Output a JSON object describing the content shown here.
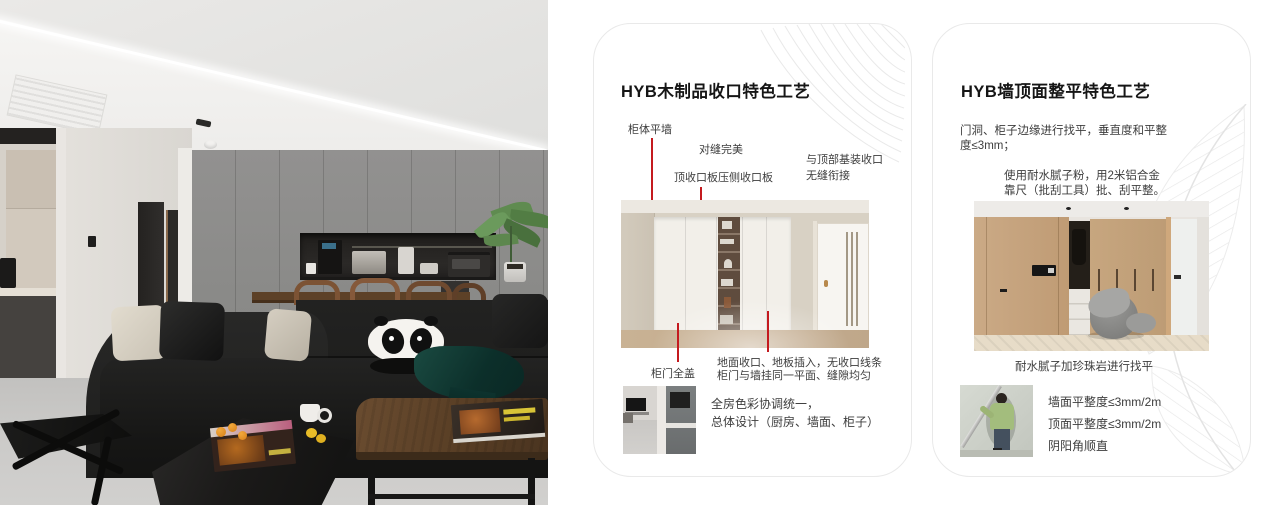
{
  "colors": {
    "accent_red": "#c41a1f",
    "card_border": "#e9e9e9",
    "title_text": "#151515",
    "body_text": "#3d3d3d"
  },
  "card1": {
    "title": "HYB木制品收口特色工艺",
    "callouts": {
      "cabinet_flush": "柜体平墙",
      "perfect_seam": "对缝完美",
      "top_board": "顶收口板压侧收口板",
      "ceiling_joint_1": "与顶部基装收口",
      "ceiling_joint_2": "无缝衔接",
      "full_cover": "柜门全盖",
      "floor_join_1": "地面收口、地板插入，无收口线条",
      "floor_join_2": "柜门与墙挂同一平面、缝隙均匀"
    },
    "summary_1": "全房色彩协调统一，",
    "summary_2": "总体设计（厨房、墙面、柜子）"
  },
  "card2": {
    "title": "HYB墙顶面整平特色工艺",
    "para1_1": "门洞、柜子边缘进行找平，垂直度和平整",
    "para1_2": "度≤3mm；",
    "para2_1": "使用耐水腻子粉，用2米铝合金",
    "para2_2": "靠尺（批刮工具）批、刮平整。",
    "caption": "耐水腻子加珍珠岩进行找平",
    "metrics": [
      "墙面平整度≤3mm/2m",
      "顶面平整度≤3mm/2m",
      "阴阳角顺直"
    ]
  }
}
